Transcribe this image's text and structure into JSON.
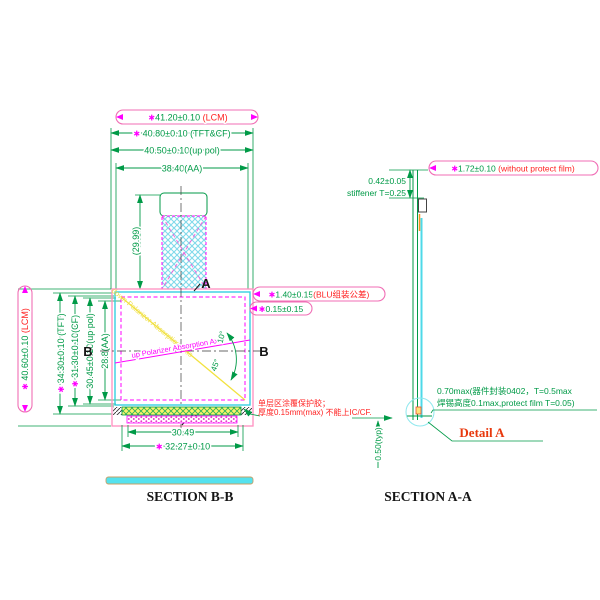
{
  "symbols": {
    "star": "✱"
  },
  "colors": {
    "dimension_green": "#009A47",
    "bubble_pink": "#F06EB5",
    "magenta": "#FF00FF",
    "lcm_pink": "#FF8FC0",
    "glass_cyan": "#35CFE0",
    "hatch_cyan": "#7FD9EA",
    "yellow": "#FBF36B",
    "note_red": "#FF2222",
    "detail_red": "#E8380D",
    "orange": "#F7941D",
    "black": "#151515"
  },
  "plan_view": {
    "section_label": "SECTION B-B",
    "top_dims": [
      {
        "value": "41.20±0.10",
        "note": "(LCM)"
      },
      {
        "value": "40.80±0.10",
        "note": "(TFT&CF)"
      },
      {
        "value": "40.50±0.10",
        "note": "(up pol)"
      },
      {
        "value": "38.40",
        "note": "(AA)"
      }
    ],
    "left_dims": [
      {
        "value": "40.60±0.10",
        "note": "(LCM)"
      },
      {
        "value": "34.30±0.10",
        "note": "(TFT)"
      },
      {
        "value": "31.30±0.10",
        "note": "(CF)"
      },
      {
        "value": "30.45±0.10",
        "note": "(up pol)"
      },
      {
        "value": "28.8",
        "note": "(AA)"
      }
    ],
    "fpc_dim": "(29.99)",
    "blu_dim": {
      "value": "1.40±0.15",
      "note": "(BLU组装公差)"
    },
    "gap_dim": {
      "value": "0.15±0.15"
    },
    "bottom_dims": [
      {
        "value": "30.49"
      },
      {
        "value": "32.27±0.10"
      }
    ],
    "angle_upper": "10°",
    "angle_lower": "45°",
    "upper_axis_label": "up Polarizer Absorption Axis",
    "lower_axis_label": "down Polarizer Absorption Axis",
    "glue_note_line1": "单层区涂覆保护胶；",
    "glue_note_line2": "厚度0.15mm(max) 不能上IC/CF.",
    "cut_label_a": "A",
    "cut_label_b": "B"
  },
  "section_aa_view": {
    "section_label": "SECTION A-A",
    "thickness_dim": {
      "value": "1.72±0.10",
      "note": "(without protect film)"
    },
    "stiffener_dim_line1": "0.42±0.05",
    "stiffener_dim_line2": "stiffener T=0.25",
    "component_note_line1": "0.70max(器件封装0402，T=0.5max",
    "component_note_line2": "焊锡高度0.1max,protect film T=0.05)",
    "fpc_tail_dim": "0.50(typ)",
    "detail_label": "Detail A"
  }
}
